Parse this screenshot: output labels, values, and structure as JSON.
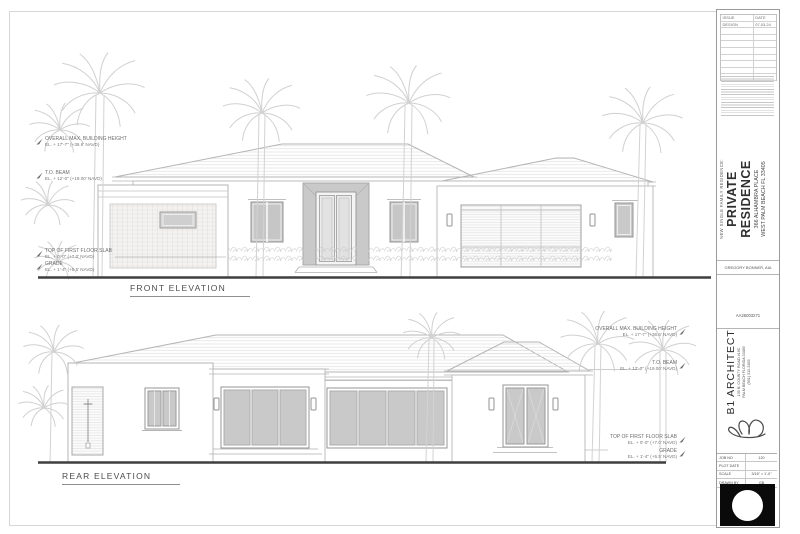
{
  "sheet": {
    "front": {
      "title": "FRONT ELEVATION",
      "ann": [
        {
          "label": "OVERALL MAX. BUILDING HEIGHT",
          "el": "EL. + 17'-7\" (+36.6' NAVD)"
        },
        {
          "label": "T.O. BEAM",
          "el": "EL. + 12'-0\" (+19.00' NAVD)"
        },
        {
          "label": "TOP OF FIRST FLOOR SLAB",
          "el": "EL. + 0'-0\" (+7.0' NAVD)"
        },
        {
          "label": "GRADE",
          "el": "EL. + 1'-4\" (+5.5' NAVD)"
        }
      ]
    },
    "rear": {
      "title": "REAR ELEVATION",
      "ann": [
        {
          "label": "OVERALL MAX. BUILDING HEIGHT",
          "el": "EL. + 17'-7\" (+36.6' NAVD)"
        },
        {
          "label": "T.O. BEAM",
          "el": "EL. + 12'-0\" (+19.00' NAVD)"
        },
        {
          "label": "TOP OF FIRST FLOOR SLAB",
          "el": "EL. + 0'-0\" (+7.0' NAVD)"
        },
        {
          "label": "GRADE",
          "el": "EL. + 1'-4\" (+5.5' NAVD)"
        }
      ]
    },
    "title_block": {
      "issue_table": {
        "col1": "ISSUE",
        "col2": "DATE",
        "rows": [
          {
            "issue": "DESIGN",
            "date": "07.03.24"
          }
        ]
      },
      "project": {
        "kind": "NEW SINGLE FAMILY RESIDENCE:",
        "name": "PRIVATE RESIDENCE",
        "addr1": "366 ALHAMBRA PLACE",
        "addr2": "WEST PALM BEACH FL 33405"
      },
      "architect": "GREGORY BONNER, AIA",
      "license": "AA26003271",
      "firm": {
        "name": "B1 ARCHITECT",
        "addr1": "139 N. COUNTY ROAD #19C",
        "addr2": "PALM BEACH FLORIDA 33480",
        "phone": "(561) 312-3453"
      },
      "info": {
        "job_label": "JOB NO",
        "job": "120",
        "plot_label": "PLOT DATE",
        "plot": "",
        "scale_label": "SCALE",
        "scale": "3/16\" = 1'-0\"",
        "drawn_label": "DRAWN BY",
        "drawn": "GB"
      }
    },
    "colors": {
      "line": "#b5b5b5",
      "glass": "#c9c9c9",
      "ground": "#3f3f3f",
      "text": "#6d6d6d"
    }
  }
}
